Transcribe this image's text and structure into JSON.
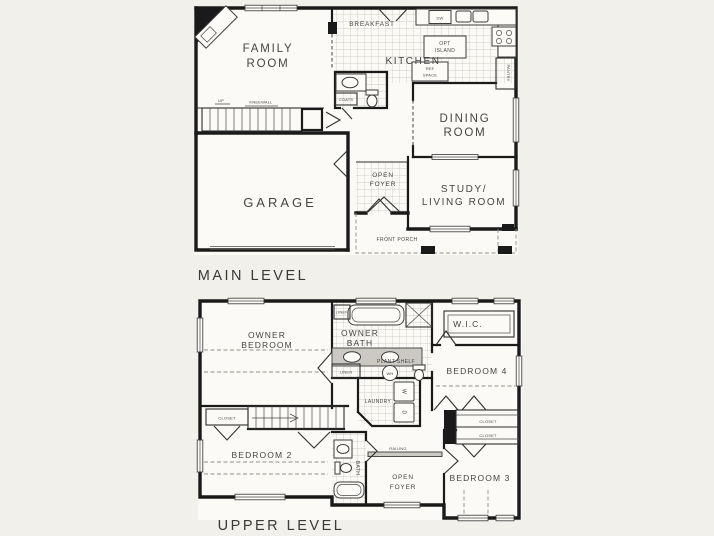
{
  "page": {
    "background": "#f2f0ea",
    "line_color": "#1a1a1a",
    "text_color": "#454545"
  },
  "main_level": {
    "title": "MAIN LEVEL",
    "rooms": {
      "family_1": "FAMILY",
      "family_2": "ROOM",
      "breakfast": "BREAKFAST",
      "kitchen": "KITCHEN",
      "dining_1": "DINING",
      "dining_2": "ROOM",
      "garage": "GARAGE",
      "foyer_1": "OPEN",
      "foyer_2": "FOYER",
      "study_1": "STUDY/",
      "study_2": "LIVING ROOM",
      "porch": "FRONT PORCH"
    },
    "features": {
      "dw": "DW",
      "opt_island_1": "OPT",
      "opt_island_2": "ISLAND",
      "ref_space_1": "REF",
      "ref_space_2": "SPACE",
      "pantry": "PANTRY",
      "coats": "COATS",
      "up": "UP",
      "kneewall": "KNEEWALL"
    }
  },
  "upper_level": {
    "title": "UPPER LEVEL",
    "rooms": {
      "owner_bed_1": "OWNER",
      "owner_bed_2": "BEDROOM",
      "owner_bath_1": "OWNER",
      "owner_bath_2": "BATH",
      "wic": "W.I.C.",
      "bedroom4": "BEDROOM 4",
      "bedroom2": "BEDROOM 2",
      "bedroom3": "BEDROOM 3",
      "bath": "BATH",
      "foyer_1": "OPEN",
      "foyer_2": "FOYER",
      "laundry": "LAUNDRY"
    },
    "features": {
      "plant_shelf": "PLANT SHELF",
      "linen": "LINEN",
      "linen_small": "LINEN",
      "wh": "WH",
      "washer": "W",
      "dryer": "D",
      "closet_bed2": "CLOSET",
      "closet_a": "CLOSET",
      "closet_b": "CLOSET",
      "railing": "RAILING"
    }
  }
}
